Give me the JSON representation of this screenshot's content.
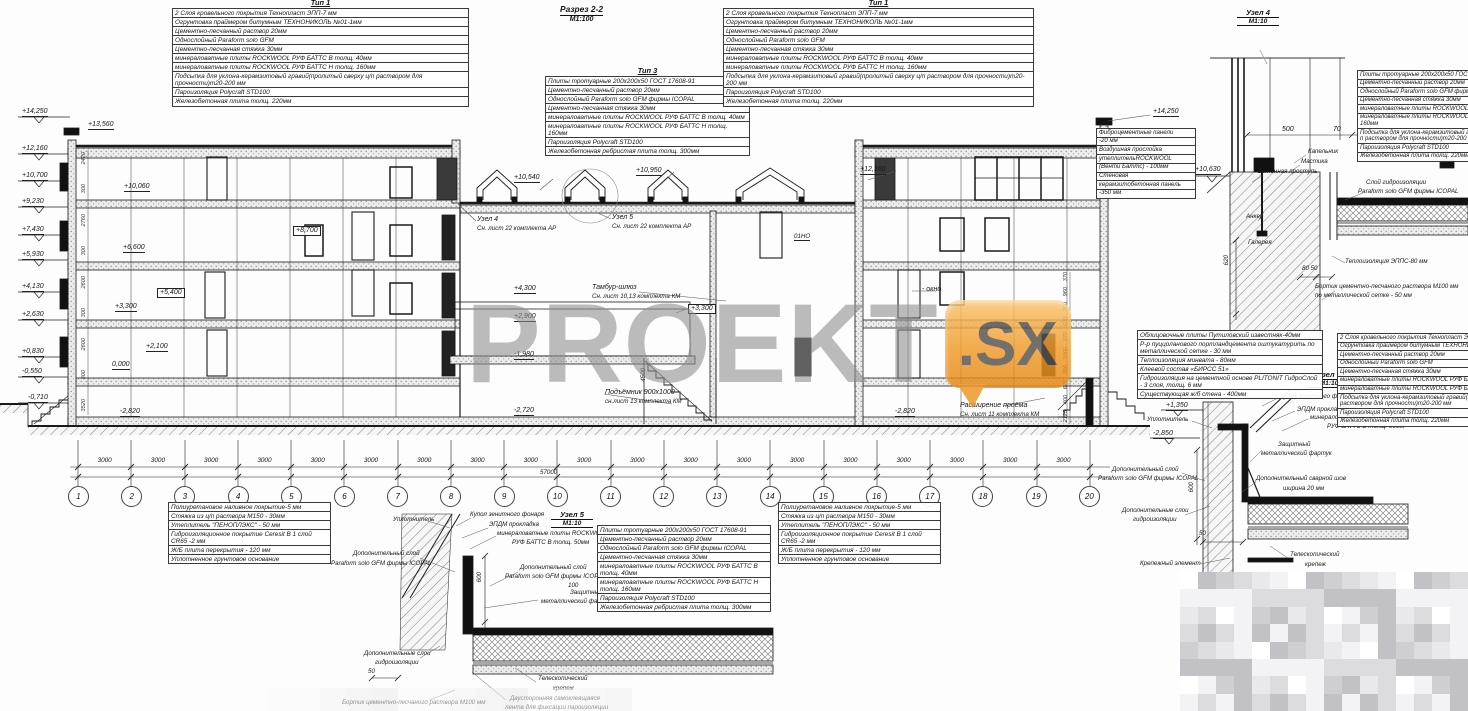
{
  "drawing_title": {
    "name": "Разрез 2-2",
    "scale": "М1:100"
  },
  "watermark": {
    "text": "PROEKT",
    "badge": ".SX"
  },
  "colors": {
    "accent_orange": "#ee9522",
    "line": "#1a1a1a",
    "watermark_gray": "#8e8e8e"
  },
  "tables": {
    "tip1": {
      "title": "Тип 1",
      "rows": [
        "2 Слоя кровельного покрытия Технопласт ЭПП-7 мм",
        "Огрунтовка праймером битумным ТЕХНОНИКОЛЬ №01-1мм",
        "Цементно-песчанный раствор 20мм",
        "Однослойный Paraform solo GFM",
        "Цементно-песчанная стяжка 30мм",
        "минераловатные плиты ROCKWOOL РУФ БАТТС В толщ. 40мм",
        "минераловатные плиты ROCKWOOL РУФ БАТТС Н толщ. 160мм",
        "Подсыпка для уклона-керамзитовый гравий(пролитый сверху ц/п раствором для прочности)m20-200 мм",
        "Пароизоляция Polycraft STD100",
        "Железобетонная плита толщ. 220мм"
      ]
    },
    "pavement": {
      "title": "Тип 3",
      "rows": [
        "Плиты тротуарные 200х200х50 ГОСТ 17608-91",
        "Цементно-песчанный раствор 20мм",
        "Однослойный Paraform solo GFM фирмы ICOPAL",
        "Цементно-песчанная стяжка 30мм",
        "минераловатные плиты ROCKWOOL РУФ БАТТС В толщ. 40мм",
        "минераловатные плиты ROCKWOOL РУФ БАТТС Н толщ. 160мм",
        "Пароизоляция Polycraft STD100",
        "Железобетонная ребристая плита толщ. 300мм"
      ]
    },
    "node4_layers": {
      "rows": [
        "Плиты тротуарные 200х200х50 ГОСТ",
        "Цементно-песчанный раствор 20мм",
        "Однослойный Paraform solo GFM фирмы",
        "Цементно-песчанная стяжка 30мм",
        "минераловатные плиты ROCKWOOL РУФ БАТТС В толщ.40мм",
        "минераловатные плиты ROCKWOOL РУФ БАТТС Н толщ. 160мм",
        "Подсыпка для уклона-керамзитовый гравий(пролитый сверху ц/п раствором для прочности)m20-200 мм",
        "Пароизоляция Polycraft STD100",
        "Железобетонная плита толщ. 220мм"
      ]
    },
    "facade_panels": {
      "rows": [
        "Фиброцементные панели",
        "-20 мм",
        "Воздушная прослойка",
        "утеплительROCKWOOL",
        "(Венти Баттс) - 100мм",
        "Стеновая",
        "керамзитобетонная панель",
        "-350 мм"
      ]
    },
    "limestone": {
      "rows": [
        "Облицовочные плиты Путиловский известняк-40мм",
        "Р-р пуццоланового портландцемента оштукатурить по металлической сетке - 30 мм",
        "Теплоизоляция минвата - 80мм",
        "Клеевой состав «БИРСС 51»",
        "Гидроизоляция на цементной основе PLITONIT ГидроСлой - 3 слоя, толщ. 6 мм",
        "Существующая ж/б стена - 400мм"
      ]
    },
    "floor_comp": {
      "rows": [
        "Полиуретановое наливное покрытие-5 мм",
        "Стяжка из ц/п раствора М150 - 30мм",
        "Утеплитель \"ПЕНОПЛЭКС\" - 50 мм",
        "Гидроизоляционное покрытие Ceresit  В 1 слой СR65 -2 мм",
        "Ж/Б плита перекрытия  - 120 мм",
        "Уплотненное грунтовое основание"
      ]
    }
  },
  "elevation_markers": [
    "+14,250",
    "+12,160",
    "+10,700",
    "+9,230",
    "+7,430",
    "+5,930",
    "+4,130",
    "+2,630",
    "+0,830",
    "-0,550",
    "-0,710"
  ],
  "axes": {
    "labels": [
      "1",
      "2",
      "3",
      "4",
      "5",
      "6",
      "7",
      "8",
      "9",
      "10",
      "11",
      "12",
      "13",
      "14",
      "15",
      "16",
      "17",
      "18",
      "19",
      "20"
    ],
    "bays": [
      "3000",
      "3000",
      "3000",
      "3000",
      "3000",
      "3000",
      "3000",
      "3000",
      "3000",
      "3000",
      "3000",
      "3000",
      "3000",
      "3000",
      "3000",
      "3000",
      "3000",
      "3000",
      "3000"
    ],
    "total": "57000"
  },
  "dims_left": [
    "2420",
    "300",
    "2760",
    "300",
    "2600",
    "300",
    "2600",
    "300",
    "3520"
  ],
  "dims_right": [
    "370",
    "960",
    "300",
    "620",
    "375",
    "1800",
    "300",
    "625",
    "400",
    "2125"
  ],
  "section_labels": {
    "parapet_top": "+13,560",
    "f4": "+10,060",
    "f4b": "+8,700",
    "f3": "+6,600",
    "f3b": "+5,400",
    "f2": "+3,300",
    "f2b": "+2,100",
    "f1": "0,000",
    "base_l": "-2,820",
    "roof_mid_l": "+10,540",
    "roof_mid_r": "+10,950",
    "node4_ref1": "Узел 4",
    "node4_ref2": "Сн. лист 22 комплекта АР",
    "node5_ref1": "Узел 5",
    "node5_ref2": "Сн. лист 22 комплекта АР",
    "room": "01НО",
    "roof_r": "+12,160",
    "tambour1": "Тамбур-шлюз",
    "tambour2": "Сн. лист 10,13 комплекта КМ",
    "t1": "+4,300",
    "t2": "+2,900",
    "t3": "+3,300",
    "t4": "-1,980",
    "lift1": "Подъёмник 900х1000",
    "lift2": "сн.лист 13 комплекта КМ",
    "base_m": "-2,720",
    "window": "- окно",
    "opening1": "Расширение проёма",
    "opening2": "Сн. лист 11 комплекта КМ",
    "base_r": "-2,820",
    "stair_dim": "4500"
  },
  "node4": {
    "title": "Узел 4",
    "scale": "М1:10",
    "elev_top": "+14,250",
    "elev": "+10,630",
    "labels": {
      "kapelnik": "Капельник",
      "mastika": "Мастика",
      "prostup": "Бетонная проступь",
      "anker": "Анкер",
      "galereya": "Галерея",
      "gidro1": "Слой гидроизоляции",
      "gidro2": "Paraform solo GFM фирмы ICOPAL",
      "teplo": "Теплоизоляция ЭППС-80 мм",
      "bortik1": "Бортик цементно-песчаного раствора М100 мм",
      "bortik2": "по металлической сетке - 50 мм"
    },
    "dims": {
      "d500": "500",
      "d70": "70",
      "d620": "620",
      "d8050": "80 50"
    }
  },
  "node5": {
    "title": "Узел 5",
    "scale": "М1:10",
    "labels": {
      "uplotnitel": "Уплотнитель",
      "kupol": "Купол зенитного фонаря",
      "epdm": "ЭПДМ прокладка",
      "minplit1": "минераловатные плиты ROCKWOOL",
      "minplit2": "РУФ БАТТС В  толщ. 50мм",
      "dop1a": "Дополнительный слой",
      "dop1b": "Paraform solo GFM фирмы ICOPAL",
      "dop2a": "Дополнительный слой",
      "dop2b": "Paraform solo GFM фирмы ICOPAL",
      "dop2c": "100",
      "fartuk1": "Защитный",
      "fartuk2": "металлический фартук",
      "gidro1": "Дополнительные слои",
      "gidro2": "гидроизоляции",
      "telescop1": "Телескопический",
      "telescop2": "крепеж",
      "bortik": "Бортик цементно-песчаного раствора М100 мм",
      "lenta1": "Двусторонняя самоклеящаяся",
      "lenta2": "лента для фиксации пароизоляции"
    },
    "dims": {
      "d600": "600",
      "d50": "50"
    }
  },
  "node6": {
    "title": "Узел 6",
    "scale": "М1:10",
    "labels": {
      "e1": "+1,350",
      "e2": "-2,850",
      "uplotnitel": "Уплотнитель",
      "kupol": "Купол зенитного фонаря",
      "epdm": "ЭПДМ прокладка",
      "minplit1": "минераловатные плиты ROCKWOOL",
      "minplit2": "РУФ БАТТС В  толщ. 50мм",
      "fartuk1": "Защитный",
      "fartuk2": "металлический фартук",
      "shov1": "Дополнительный сварной шов",
      "shov2": "ширина 20 мм",
      "dop1a": "Дополнительный слой",
      "dop1b": "Paraform solo GFM фирмы ICOPAL",
      "gidro1": "Дополнительные слои",
      "gidro2": "гидроизоляции",
      "krep": "Крепежный элемент",
      "telescop1": "Телескопический",
      "telescop2": "крепеж"
    },
    "dims": {
      "d600": "600",
      "d50": "50"
    }
  }
}
